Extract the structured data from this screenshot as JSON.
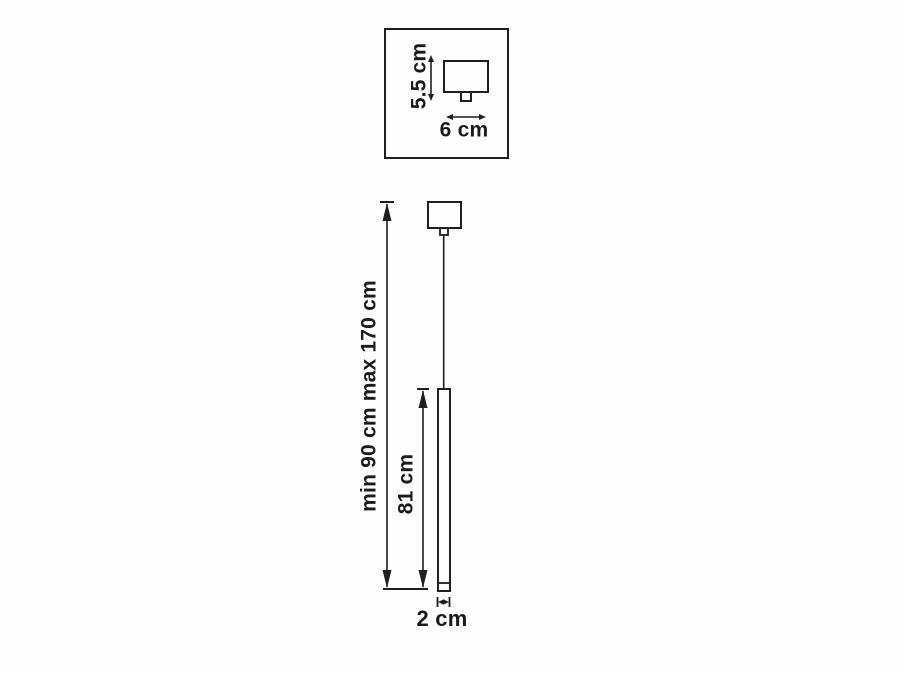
{
  "page": {
    "background_color": "#fefefe",
    "line_color": "#1f1f1f",
    "text_color": "#1a1a1a"
  },
  "diagram": {
    "type": "product-dimension-drawing",
    "subject": "pendant lamp with ceiling canopy and thin tube shade",
    "detail_box": {
      "height_label": "5.5 cm",
      "width_label": "6 cm"
    },
    "main_view": {
      "overall_height_label": "min 90 cm max 170 cm",
      "tube_length_label": "81 cm",
      "tube_diameter_label": "2 cm"
    }
  }
}
